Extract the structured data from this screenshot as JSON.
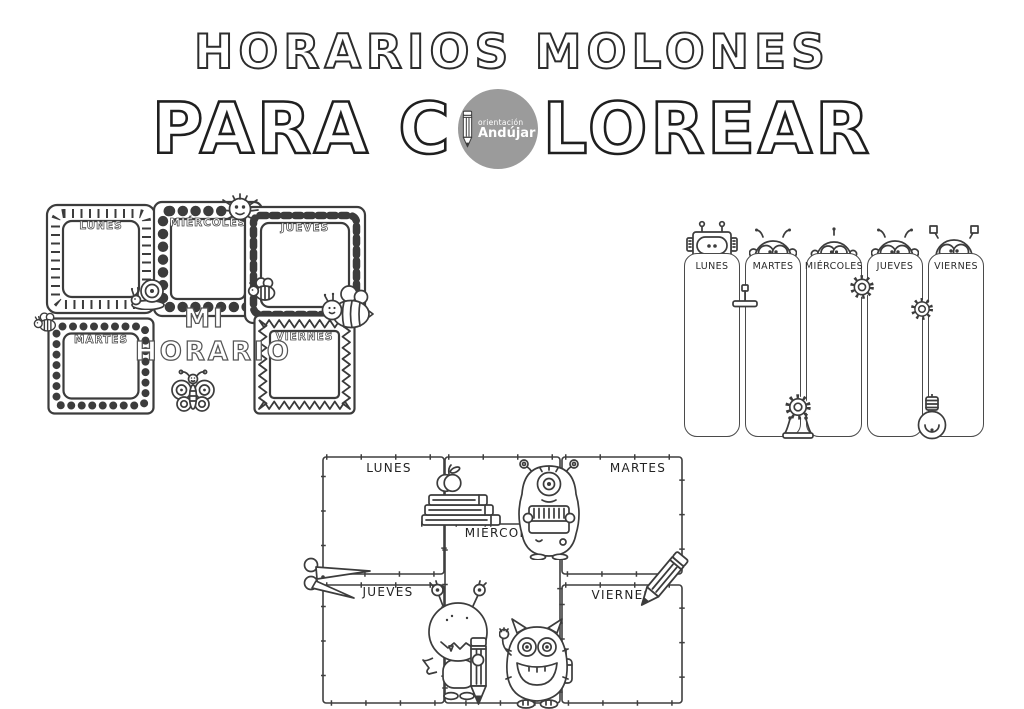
{
  "header": {
    "title": "HORARIOS MOLONES",
    "subtitle_prefix": "PARA C",
    "subtitle_suffix": "LOREAR",
    "logo": {
      "line1": "orientación",
      "line2": "Andújar"
    }
  },
  "left_schedule": {
    "heading_line1": "MI",
    "heading_line2": "HORARIO",
    "days": {
      "lunes": "LUNES",
      "martes": "MARTES",
      "miercoles": "MIÉRCOLES",
      "jueves": "JUEVES",
      "viernes": "VIERNES"
    }
  },
  "right_schedule": {
    "days": [
      "LUNES",
      "MARTES",
      "MIÉRCOLES",
      "JUEVES",
      "VIERNES"
    ]
  },
  "bottom_schedule": {
    "days": {
      "lunes": "LUNES",
      "martes": "MARTES",
      "miercoles": "MIÉRCOLES",
      "jueves": "JUEVES",
      "viernes": "VIERNES"
    }
  },
  "icons": {
    "logo-pencil-icon": "pencil",
    "snail-icon": "snail",
    "spider-icon": "spider",
    "bee-icon": "bee",
    "big-bee-icon": "bee with face",
    "butterfly-icon": "butterfly",
    "robot-head-icon": "robot head",
    "gear-icon": "gear",
    "gear-stand-icon": "gear on stand",
    "lever-icon": "lever tool",
    "lightbulb-icon": "hanging light bulb",
    "books-icon": "stack of books",
    "apple-icon": "apple",
    "scissors-icon": "scissors",
    "pencil-icon": "pencil",
    "cyclops-monster-icon": "one-eyed monster reading a book",
    "bighead-monster-icon": "monster holding a big pencil",
    "furry-monster-icon": "waving furry monster"
  },
  "colors": {
    "ink": "#3c3c3c",
    "logo_gray": "#9b9b9b",
    "background": "#ffffff"
  }
}
